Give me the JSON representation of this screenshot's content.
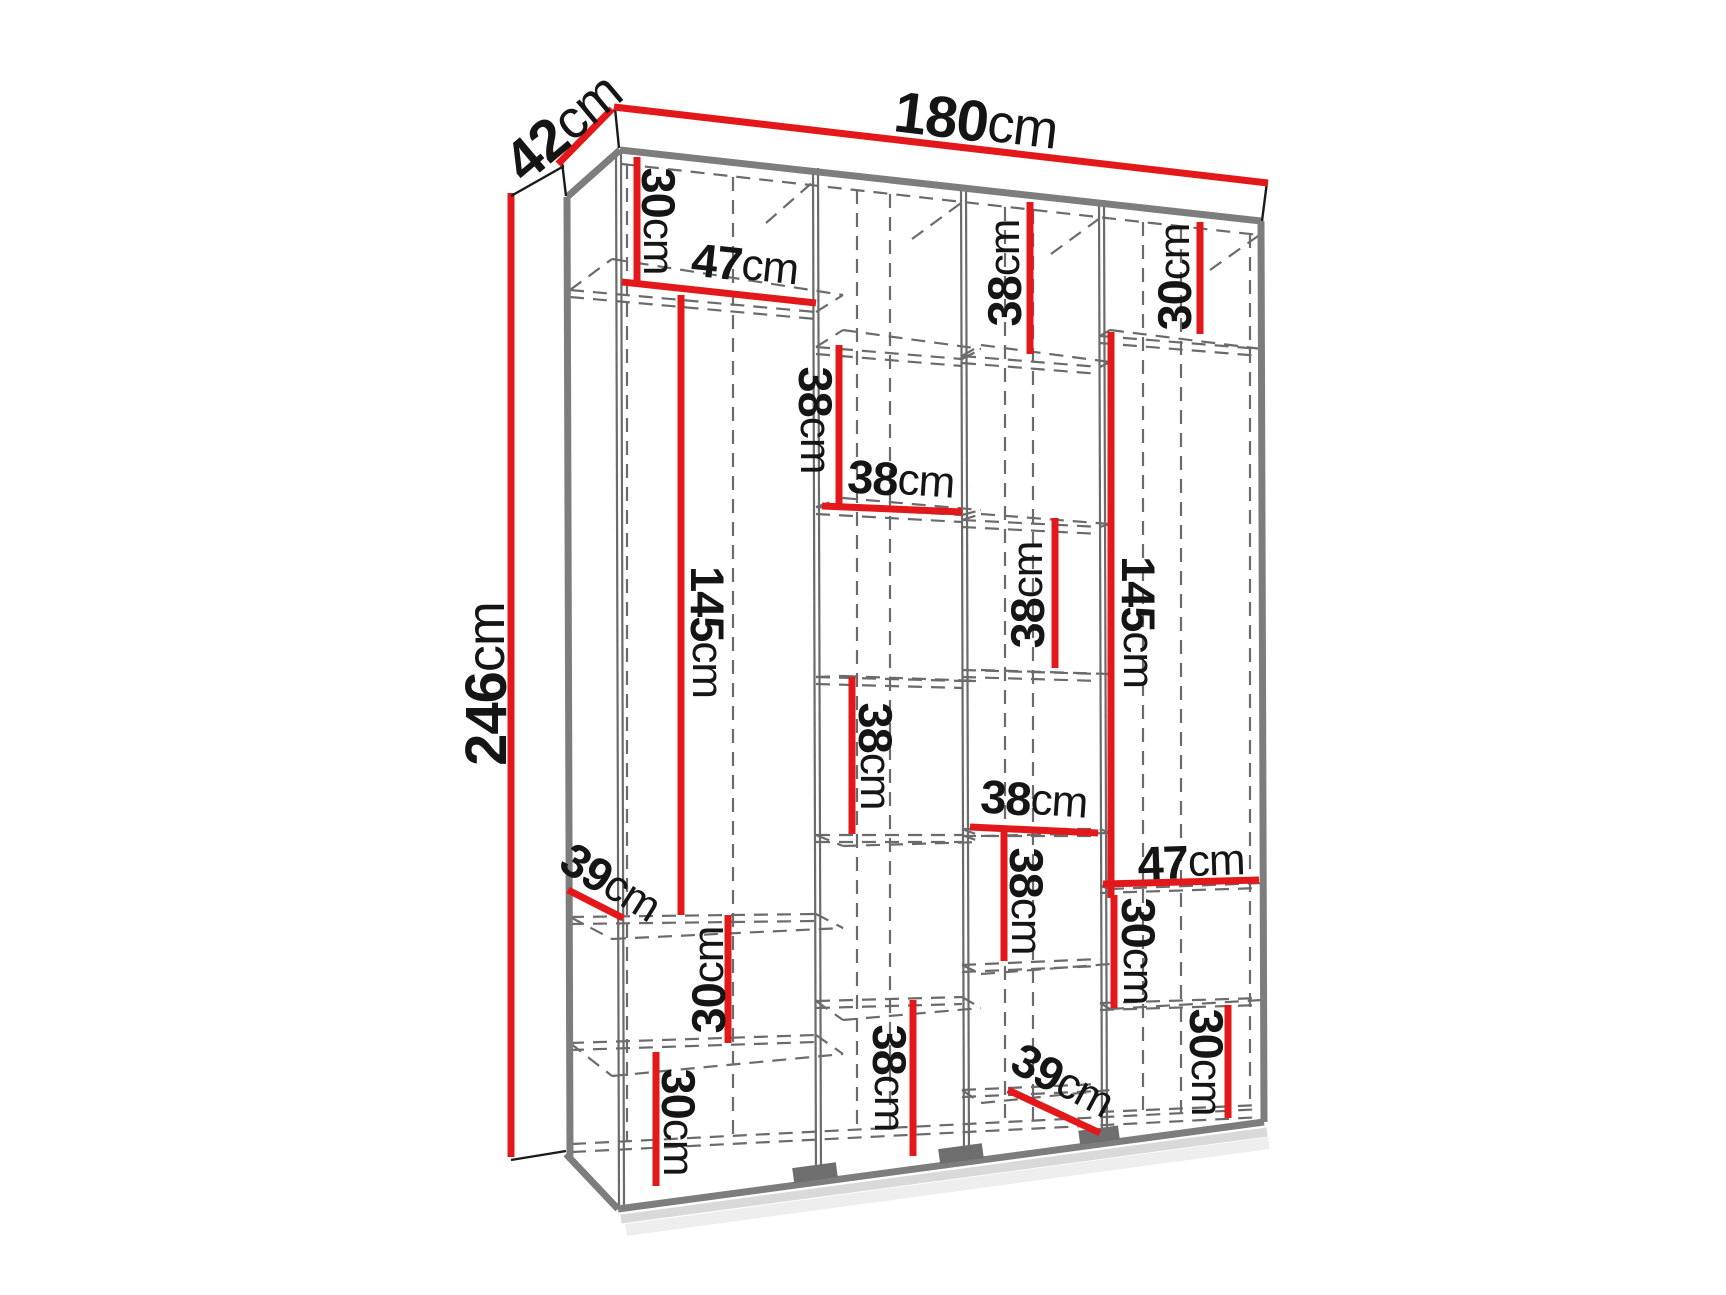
{
  "canvas": {
    "width": 1726,
    "height": 1295,
    "background": "#ffffff"
  },
  "colors": {
    "dimension_red": "#e3181b",
    "label_black": "#151515",
    "edge_gray": "#7d7d7d",
    "structure_gray": "#6b6b6b",
    "dash_gray": "#6b6b6b",
    "shadow_light": "#d9d9d9",
    "shadow_lighter": "#eeeeee",
    "foot_gray": "#6e6e6e",
    "panel_white": "#ffffff",
    "outline_black": "#1a1a1a"
  },
  "overall_dimensions": [
    {
      "id": "width-180cm",
      "value": "180",
      "unit": "cm",
      "text": {
        "x": 976,
        "y": 121,
        "rot": 7,
        "size": 58
      },
      "line": [
        614,
        107,
        1268,
        183
      ]
    },
    {
      "id": "depth-42cm",
      "value": "42",
      "unit": "cm",
      "text": {
        "x": 563,
        "y": 127,
        "rot": -40,
        "size": 58
      },
      "line": [
        558,
        164,
        612,
        109
      ]
    },
    {
      "id": "height-246cm",
      "value": "246",
      "unit": "cm",
      "text": {
        "x": 486,
        "y": 684,
        "rot": -90,
        "size": 58
      },
      "line": [
        511,
        193,
        511,
        1157
      ],
      "ticks": [
        [
          511,
          196,
          564,
          166
        ],
        [
          511,
          1160,
          566,
          1151
        ]
      ]
    }
  ],
  "cell_dimensions": [
    {
      "id": "col1-top-30cm",
      "value": "30",
      "unit": "cm",
      "text": {
        "x": 659,
        "y": 221,
        "rot": 90,
        "size": 47
      },
      "line": [
        637,
        157,
        637,
        285
      ]
    },
    {
      "id": "col1-47cm",
      "value": "47",
      "unit": "cm",
      "text": {
        "x": 745,
        "y": 264,
        "rot": 6,
        "size": 47
      },
      "line": [
        622,
        282,
        816,
        303
      ]
    },
    {
      "id": "col1-145cm",
      "value": "145",
      "unit": "cm",
      "text": {
        "x": 708,
        "y": 632,
        "rot": 90,
        "size": 47
      },
      "line": [
        681,
        295,
        681,
        915
      ]
    },
    {
      "id": "col1-39cm",
      "value": "39",
      "unit": "cm",
      "text": {
        "x": 611,
        "y": 882,
        "rot": 32,
        "size": 47
      },
      "line": [
        568,
        890,
        623,
        918
      ]
    },
    {
      "id": "col1-mid-30cm",
      "value": "30",
      "unit": "cm",
      "text": {
        "x": 708,
        "y": 980,
        "rot": -90,
        "size": 47
      },
      "line": [
        728,
        915,
        728,
        1043
      ]
    },
    {
      "id": "col1-bottom-30cm",
      "value": "30",
      "unit": "cm",
      "text": {
        "x": 679,
        "y": 1122,
        "rot": 90,
        "size": 47
      },
      "line": [
        656,
        1052,
        656,
        1186
      ]
    },
    {
      "id": "col2-38cm-v1",
      "value": "38",
      "unit": "cm",
      "text": {
        "x": 816,
        "y": 420,
        "rot": 90,
        "size": 47
      },
      "line": [
        839,
        345,
        839,
        504
      ]
    },
    {
      "id": "col2-38cm-h",
      "value": "38",
      "unit": "cm",
      "text": {
        "x": 901,
        "y": 479,
        "rot": 4,
        "size": 47
      },
      "line": [
        822,
        506,
        962,
        512
      ]
    },
    {
      "id": "col2-38cm-v2",
      "value": "38",
      "unit": "cm",
      "text": {
        "x": 876,
        "y": 756,
        "rot": 90,
        "size": 47
      },
      "line": [
        852,
        677,
        852,
        834
      ]
    },
    {
      "id": "col2-bottom-38cm",
      "value": "38",
      "unit": "cm",
      "text": {
        "x": 890,
        "y": 1078,
        "rot": 90,
        "size": 47
      },
      "line": [
        913,
        1000,
        913,
        1156
      ]
    },
    {
      "id": "col3-top-38cm",
      "value": "38",
      "unit": "cm",
      "text": {
        "x": 1004,
        "y": 273,
        "rot": -90,
        "size": 47
      },
      "line": [
        1030,
        202,
        1030,
        354
      ]
    },
    {
      "id": "col3-mid-38cm",
      "value": "38",
      "unit": "cm",
      "text": {
        "x": 1027,
        "y": 595,
        "rot": -90,
        "size": 47
      },
      "line": [
        1055,
        518,
        1055,
        668
      ]
    },
    {
      "id": "col3-38cm-h",
      "value": "38",
      "unit": "cm",
      "text": {
        "x": 1034,
        "y": 799,
        "rot": 4,
        "size": 47
      },
      "line": [
        970,
        827,
        1098,
        833
      ]
    },
    {
      "id": "col3-38cm-v",
      "value": "38",
      "unit": "cm",
      "text": {
        "x": 1027,
        "y": 901,
        "rot": 90,
        "size": 47
      },
      "line": [
        1004,
        830,
        1004,
        961
      ]
    },
    {
      "id": "col3-39cm",
      "value": "39",
      "unit": "cm",
      "text": {
        "x": 1063,
        "y": 1080,
        "rot": 28,
        "size": 47
      },
      "line": [
        1008,
        1090,
        1100,
        1133
      ]
    },
    {
      "id": "col4-top-30cm",
      "value": "30",
      "unit": "cm",
      "text": {
        "x": 1174,
        "y": 277,
        "rot": -90,
        "size": 47
      },
      "line": [
        1200,
        222,
        1200,
        334
      ]
    },
    {
      "id": "col4-145cm",
      "value": "145",
      "unit": "cm",
      "text": {
        "x": 1139,
        "y": 622,
        "rot": 90,
        "size": 47
      },
      "line": [
        1111,
        332,
        1111,
        898
      ]
    },
    {
      "id": "col4-47cm",
      "value": "47",
      "unit": "cm",
      "text": {
        "x": 1191,
        "y": 861,
        "rot": -2,
        "size": 47
      },
      "line": [
        1103,
        884,
        1259,
        880
      ]
    },
    {
      "id": "col4-mid-30cm",
      "value": "30",
      "unit": "cm",
      "text": {
        "x": 1139,
        "y": 951,
        "rot": 90,
        "size": 47
      },
      "line": [
        1114,
        895,
        1114,
        1008
      ]
    },
    {
      "id": "col4-bottom-30cm",
      "value": "30",
      "unit": "cm",
      "text": {
        "x": 1207,
        "y": 1062,
        "rot": 90,
        "size": 47
      },
      "line": [
        1228,
        1005,
        1228,
        1118
      ]
    }
  ],
  "wireframe": {
    "polygons": [
      {
        "name": "top-panel-face",
        "points": [
          [
            615,
            107
          ],
          [
            1268,
            182
          ],
          [
            1262,
            221
          ],
          [
            619,
            148
          ]
        ]
      },
      {
        "name": "left-panel-top-face",
        "points": [
          [
            562,
            162
          ],
          [
            614,
            110
          ],
          [
            619,
            148
          ],
          [
            566,
            197
          ]
        ]
      }
    ],
    "thick_edges": [
      [
        620,
        150,
        1261,
        221
      ],
      [
        567,
        197,
        620,
        150
      ],
      [
        567,
        197,
        570,
        1156
      ],
      [
        1261,
        221,
        1264,
        1122
      ],
      [
        566,
        1154,
        618,
        1209
      ],
      [
        618,
        1209,
        1264,
        1122
      ]
    ],
    "black_edges": [
      [
        615,
        108,
        619,
        148
      ],
      [
        1267,
        182,
        1262,
        221
      ],
      [
        562,
        162,
        614,
        110
      ],
      [
        562,
        162,
        566,
        196
      ]
    ],
    "solid_lines": [
      [
        616,
        150,
        619,
        1207
      ],
      [
        621,
        150,
        624,
        1206
      ],
      [
        813,
        168,
        816,
        1182
      ],
      [
        818,
        168,
        821,
        1181
      ],
      [
        961,
        185,
        964,
        1163
      ],
      [
        966,
        185,
        969,
        1162
      ],
      [
        1099,
        200,
        1102,
        1144
      ],
      [
        1104,
        200,
        1107,
        1143
      ]
    ],
    "dashed_lines": [
      [
        622,
        164,
        1259,
        235
      ],
      [
        572,
        1144,
        1263,
        1109
      ],
      [
        572,
        1152,
        1263,
        1117
      ],
      [
        627,
        165,
        627,
        1141
      ],
      [
        733,
        177,
        733,
        1136
      ],
      [
        857,
        190,
        857,
        1129
      ],
      [
        890,
        194,
        890,
        1128
      ],
      [
        1005,
        207,
        1005,
        1122
      ],
      [
        1033,
        210,
        1033,
        1120
      ],
      [
        1143,
        222,
        1143,
        1114
      ],
      [
        1181,
        226,
        1181,
        1112
      ],
      [
        1250,
        234,
        1250,
        1108
      ],
      [
        766,
        223,
        814,
        181
      ],
      [
        912,
        239,
        961,
        203
      ],
      [
        1051,
        254,
        1100,
        218
      ],
      [
        1210,
        270,
        1258,
        236
      ],
      [
        570,
        290,
        816,
        312
      ],
      [
        570,
        297,
        816,
        319
      ],
      [
        570,
        290,
        612,
        259
      ],
      [
        816,
        312,
        843,
        295
      ],
      [
        612,
        259,
        843,
        295
      ],
      [
        570,
        917,
        816,
        914
      ],
      [
        570,
        924,
        816,
        921
      ],
      [
        570,
        917,
        612,
        939
      ],
      [
        816,
        914,
        843,
        928
      ],
      [
        612,
        939,
        843,
        928
      ],
      [
        570,
        1043,
        816,
        1035
      ],
      [
        570,
        1050,
        816,
        1042
      ],
      [
        570,
        1043,
        612,
        1076
      ],
      [
        816,
        1035,
        843,
        1054
      ],
      [
        612,
        1076,
        843,
        1054
      ],
      [
        816,
        347,
        962,
        359
      ],
      [
        816,
        354,
        962,
        366
      ],
      [
        816,
        347,
        843,
        330
      ],
      [
        962,
        359,
        981,
        349
      ],
      [
        843,
        330,
        981,
        349
      ],
      [
        816,
        507,
        962,
        515
      ],
      [
        816,
        514,
        962,
        522
      ],
      [
        816,
        507,
        843,
        498
      ],
      [
        962,
        515,
        981,
        510
      ],
      [
        843,
        498,
        981,
        510
      ],
      [
        816,
        677,
        962,
        681
      ],
      [
        816,
        684,
        962,
        688
      ],
      [
        816,
        677,
        843,
        676
      ],
      [
        962,
        681,
        981,
        681
      ],
      [
        843,
        676,
        981,
        681
      ],
      [
        816,
        835,
        962,
        835
      ],
      [
        816,
        842,
        962,
        842
      ],
      [
        816,
        835,
        843,
        846
      ],
      [
        962,
        835,
        981,
        842
      ],
      [
        843,
        846,
        981,
        842
      ],
      [
        816,
        1001,
        962,
        997
      ],
      [
        816,
        1008,
        962,
        1004
      ],
      [
        816,
        1001,
        843,
        1020
      ],
      [
        962,
        997,
        981,
        1008
      ],
      [
        843,
        1020,
        981,
        1008
      ],
      [
        962,
        356,
        1100,
        367
      ],
      [
        962,
        363,
        1100,
        374
      ],
      [
        962,
        356,
        981,
        345
      ],
      [
        1100,
        367,
        1110,
        362
      ],
      [
        981,
        345,
        1110,
        362
      ],
      [
        962,
        520,
        1100,
        527
      ],
      [
        962,
        527,
        1100,
        534
      ],
      [
        962,
        520,
        981,
        514
      ],
      [
        1100,
        527,
        1110,
        524
      ],
      [
        981,
        514,
        1110,
        524
      ],
      [
        962,
        670,
        1100,
        674
      ],
      [
        962,
        677,
        1100,
        681
      ],
      [
        981,
        670,
        1110,
        674
      ],
      [
        962,
        829,
        1100,
        829
      ],
      [
        962,
        836,
        1100,
        836
      ],
      [
        962,
        829,
        981,
        836
      ],
      [
        1100,
        829,
        1110,
        833
      ],
      [
        981,
        836,
        1110,
        833
      ],
      [
        962,
        965,
        1100,
        959
      ],
      [
        962,
        972,
        1100,
        966
      ],
      [
        962,
        965,
        981,
        974
      ],
      [
        981,
        974,
        1110,
        964
      ],
      [
        962,
        1090,
        1100,
        1084
      ],
      [
        962,
        1097,
        1100,
        1091
      ],
      [
        962,
        1090,
        981,
        1103
      ],
      [
        981,
        1103,
        1110,
        1090
      ],
      [
        1100,
        336,
        1261,
        349
      ],
      [
        1100,
        343,
        1261,
        356
      ],
      [
        1100,
        336,
        1110,
        330
      ],
      [
        1110,
        330,
        1262,
        349
      ],
      [
        1100,
        886,
        1261,
        881
      ],
      [
        1100,
        893,
        1261,
        888
      ],
      [
        1100,
        886,
        1110,
        889
      ],
      [
        1110,
        889,
        1262,
        883
      ],
      [
        1100,
        1003,
        1261,
        998
      ],
      [
        1100,
        1010,
        1261,
        1005
      ],
      [
        1100,
        1003,
        1110,
        1009
      ],
      [
        1110,
        1009,
        1262,
        1000
      ],
      [
        1100,
        1112,
        1261,
        1105
      ]
    ],
    "shadow_lines": [
      [
        621,
        1219,
        1267,
        1132
      ],
      [
        626,
        1230,
        1269,
        1143
      ]
    ],
    "feet": [
      {
        "cx": 816,
        "edge_y": 1180,
        "w": 44,
        "h": 15
      },
      {
        "cx": 962,
        "edge_y": 1161,
        "w": 44,
        "h": 15
      },
      {
        "cx": 1100,
        "edge_y": 1142,
        "w": 40,
        "h": 14
      }
    ],
    "base_angle_deg": -7.7
  }
}
